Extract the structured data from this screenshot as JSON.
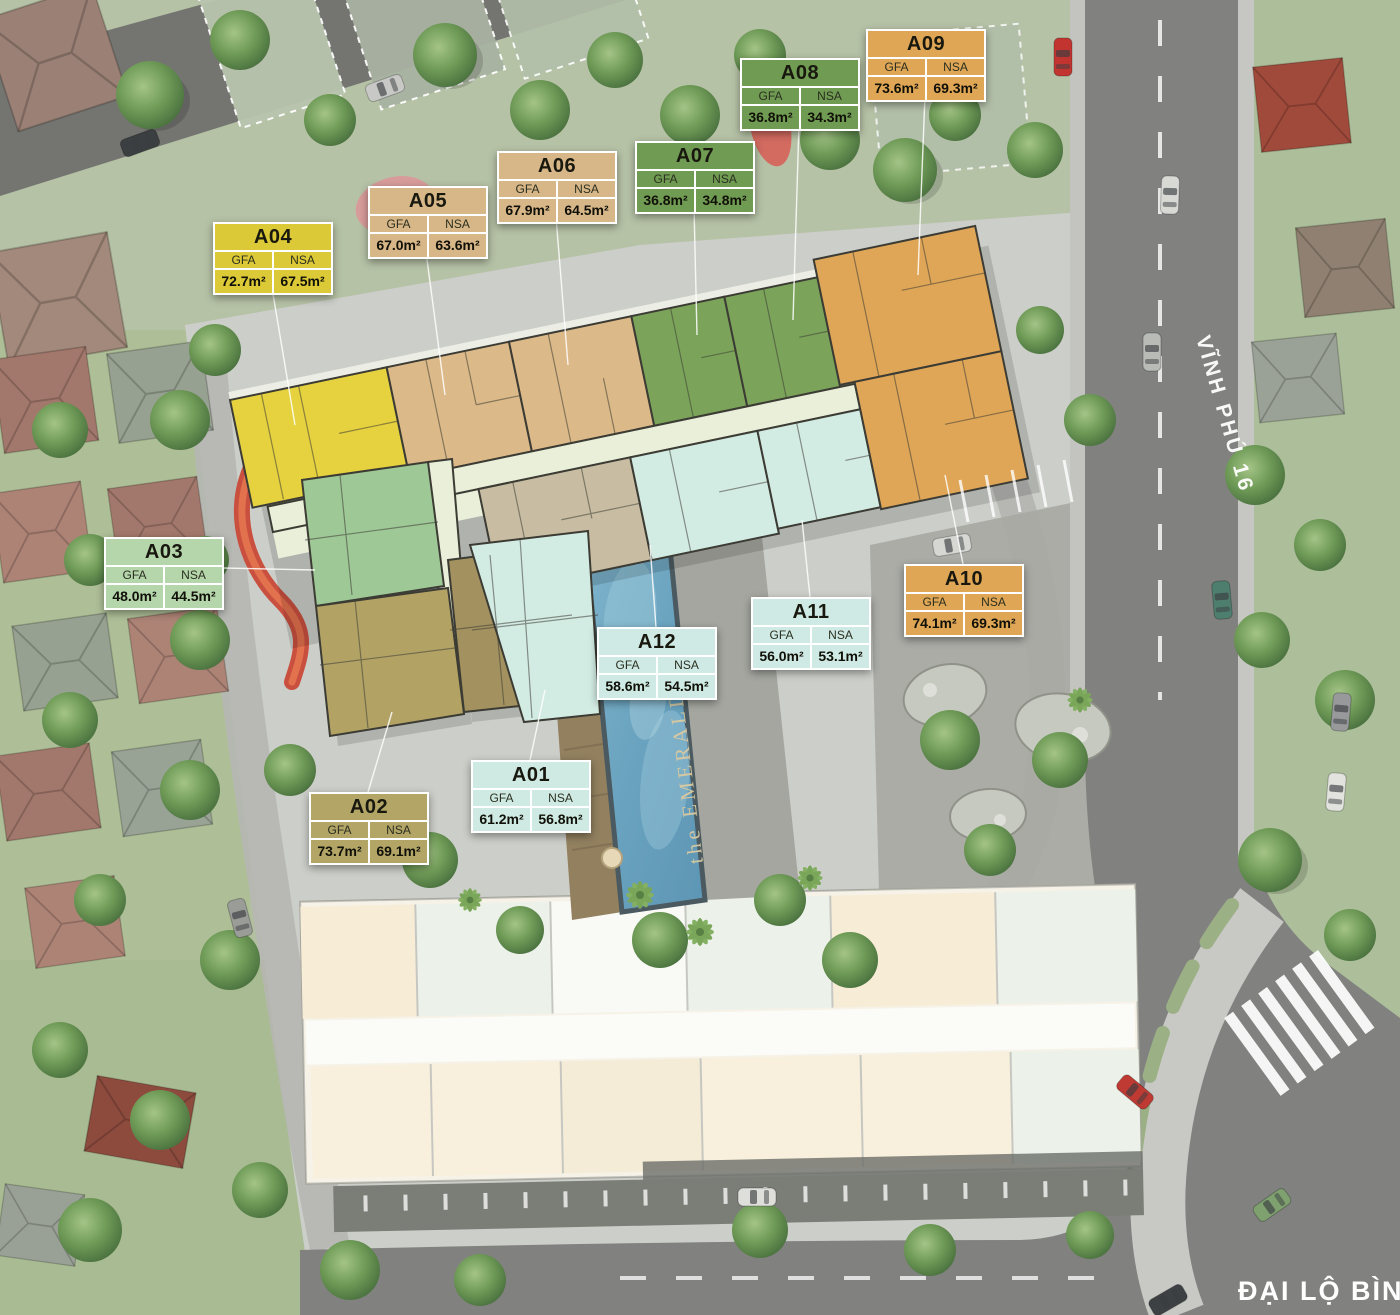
{
  "labels": {
    "gfa": "GFA",
    "nsa": "NSA"
  },
  "units": [
    {
      "code": "A01",
      "gfa": "61.2m²",
      "nsa": "56.8m²",
      "color": "#cfeae2"
    },
    {
      "code": "A02",
      "gfa": "73.7m²",
      "nsa": "69.1m²",
      "color": "#b2a566"
    },
    {
      "code": "A03",
      "gfa": "48.0m²",
      "nsa": "44.5m²",
      "color": "#b5d5ab"
    },
    {
      "code": "A04",
      "gfa": "72.7m²",
      "nsa": "67.5m²",
      "color": "#dcc937"
    },
    {
      "code": "A05",
      "gfa": "67.0m²",
      "nsa": "63.6m²",
      "color": "#d7b687"
    },
    {
      "code": "A06",
      "gfa": "67.9m²",
      "nsa": "64.5m²",
      "color": "#d7b687"
    },
    {
      "code": "A07",
      "gfa": "36.8m²",
      "nsa": "34.8m²",
      "color": "#709b52"
    },
    {
      "code": "A08",
      "gfa": "36.8m²",
      "nsa": "34.3m²",
      "color": "#709b52"
    },
    {
      "code": "A09",
      "gfa": "73.6m²",
      "nsa": "69.3m²",
      "color": "#dfa655"
    },
    {
      "code": "A10",
      "gfa": "74.1m²",
      "nsa": "69.3m²",
      "color": "#dfa655"
    },
    {
      "code": "A11",
      "gfa": "56.0m²",
      "nsa": "53.1m²",
      "color": "#cfeae4"
    },
    {
      "code": "A12",
      "gfa": "58.6m²",
      "nsa": "54.5m²",
      "color": "#cfeae4"
    }
  ],
  "streets": {
    "vinh_phu_16": "VĨNH PHÚ 16",
    "dai_lo_binh": "ĐẠI LỘ BÌNH"
  },
  "pool_name": "the EMERALD"
}
